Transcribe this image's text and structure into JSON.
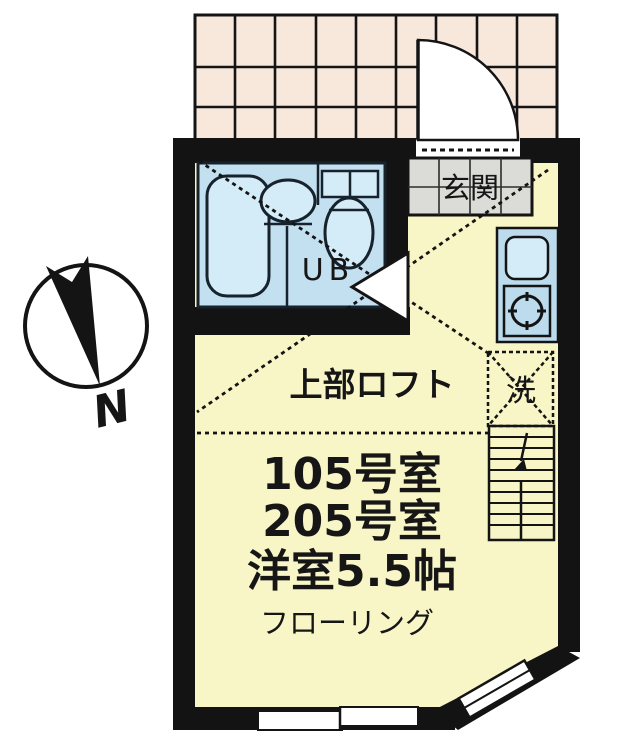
{
  "floorplan": {
    "title_context": "apartment-unit-floorplan",
    "compass": {
      "north_label": "N"
    },
    "entrance": {
      "label": "玄関"
    },
    "bathroom": {
      "label": "UB"
    },
    "loft": {
      "label": "上部ロフト"
    },
    "laundry": {
      "label": "洗"
    },
    "room": {
      "line1": "105号室",
      "line2": "205号室",
      "line3": "洋室5.5帖",
      "line4": "フローリング"
    },
    "colors": {
      "wall": "#131313",
      "room_floor": "#f8f5c6",
      "bath_floor": "#c3e0f1",
      "fixture": "#d4ebf8",
      "fixture_stroke": "#16222c",
      "kitchen": "#bcdcee",
      "porch_tile": "#f8e8dc",
      "genkan_tile": "#dbdbd7",
      "line": "#141414",
      "white": "#ffffff"
    }
  }
}
